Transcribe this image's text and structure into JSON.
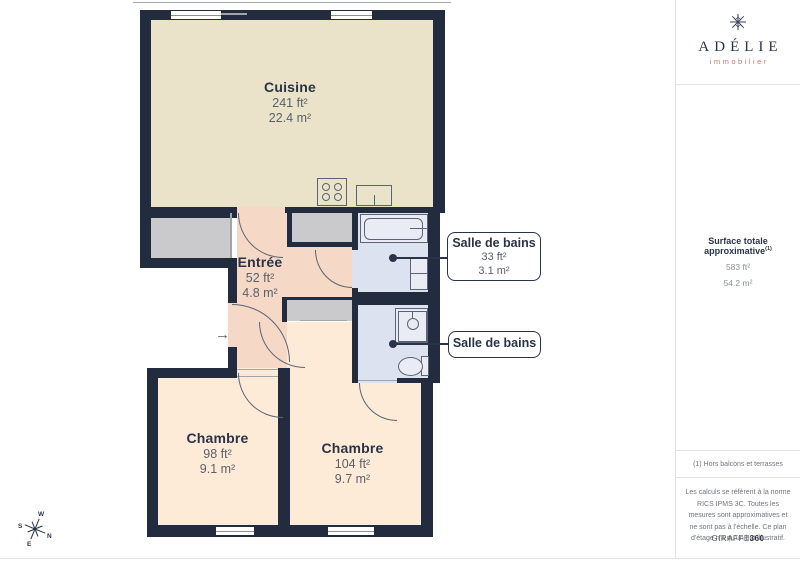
{
  "colors": {
    "wall": "#232c3e",
    "kitchen": "#ebe3c9",
    "entree": "#f5d8c5",
    "bedroom": "#fdead7",
    "bathroom": "#dde2f0",
    "grayroom": "#cacacc",
    "fixfill": "#e9ecf5",
    "line": "#5b6474",
    "navy": "#2a3347",
    "tgray": "#5b616b",
    "coral": "#c5796d",
    "divider": "#e4e4e8"
  },
  "plan": {
    "rooms": [
      {
        "name": "Cuisine",
        "ft": "241 ft²",
        "m": "22.4 m²"
      },
      {
        "name": "Entrée",
        "ft": "52 ft²",
        "m": "4.8 m²"
      },
      {
        "name": "Chambre",
        "ft": "98 ft²",
        "m": "9.1 m²"
      },
      {
        "name": "Chambre",
        "ft": "104 ft²",
        "m": "9.7 m²"
      }
    ],
    "callouts": [
      {
        "label": "Salle de bains",
        "ft": "33 ft²",
        "m": "3.1 m²"
      },
      {
        "label": "Salle de bains"
      }
    ],
    "compass": {
      "n": "N",
      "s": "S",
      "e": "E",
      "w": "W"
    },
    "entry_arrow": "→",
    "icons": {
      "logo": "snowflake",
      "compass": "compass-rose",
      "fixtures": [
        "stove",
        "sink",
        "bathtub",
        "washbasin",
        "shower",
        "toilet"
      ]
    }
  },
  "sidebar": {
    "logo": {
      "name": "ADÉLIE",
      "tagline": "immobilier"
    },
    "surface": {
      "title": "Surface totale approximative",
      "sup": "(1)",
      "ft": "583 ft²",
      "m": "54.2 m²"
    },
    "footnote": "(1) Hors balcons et terrasses",
    "disclaimer": "Les calculs se réfèrent à la norme RICS IPMS 3C. Toutes les mesures sont approximatives et ne sont pas à l'échelle. Ce plan d'étage n'a qu'un but illustratif.",
    "brand": {
      "name": "GIRAFFE",
      "suffix": "360"
    }
  }
}
